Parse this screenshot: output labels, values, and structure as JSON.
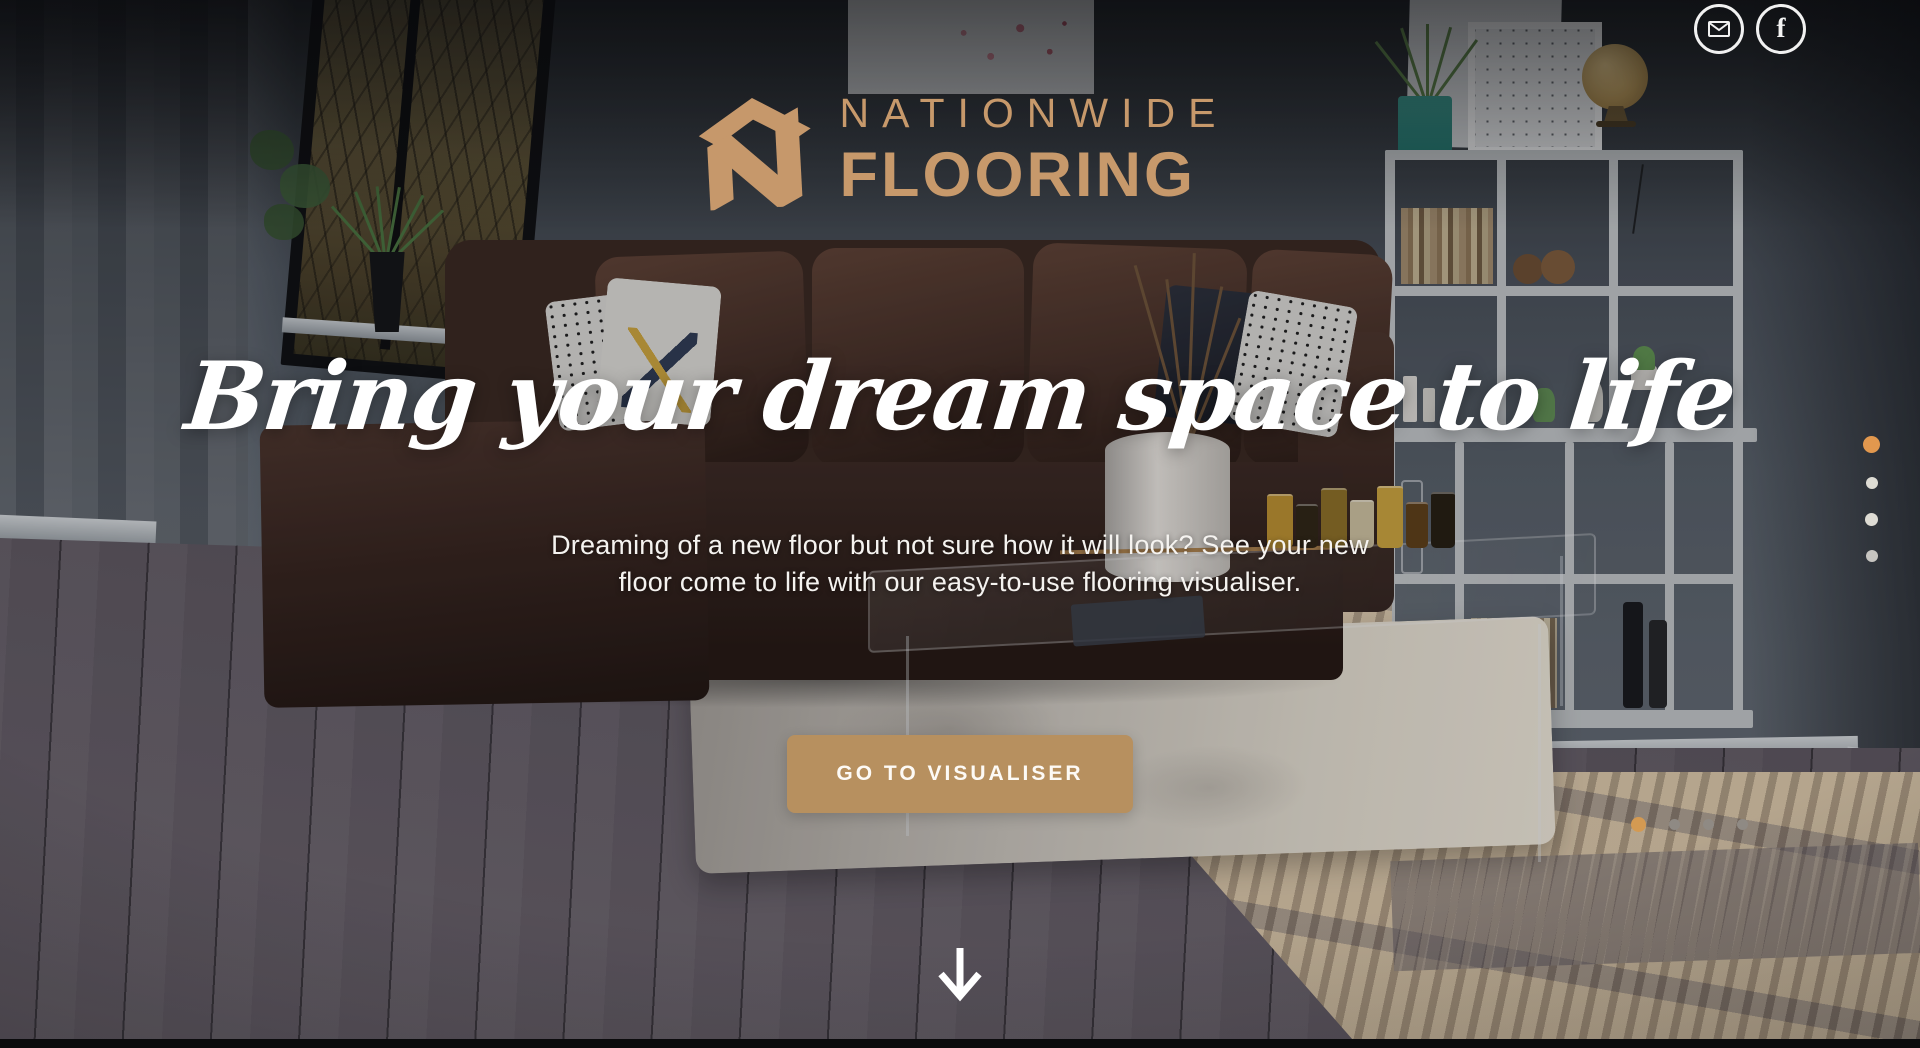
{
  "brand": {
    "name_line1": "NATIONWIDE",
    "name_line2": "FLOORING",
    "gold": "#C7996B"
  },
  "social": {
    "facebook_letter": "f"
  },
  "hero": {
    "headline": "Bring your dream space to life",
    "subtext_line1": "Dreaming of a new floor but not sure how it will look? See your new",
    "subtext_line2": "floor come to life with our easy-to-use flooring visualiser.",
    "cta_label": "GO TO VISUALISER"
  },
  "colors": {
    "cta_background": "#B7905F",
    "active_dot": "#E2984E",
    "inactive_dot_light": "#EEEAE2",
    "inactive_dot_dark": "#8F8A84"
  },
  "carousel_vertical": {
    "dot_count": 4,
    "active_index": 0
  },
  "carousel_horizontal": {
    "dot_count": 4,
    "active_index": 0
  }
}
